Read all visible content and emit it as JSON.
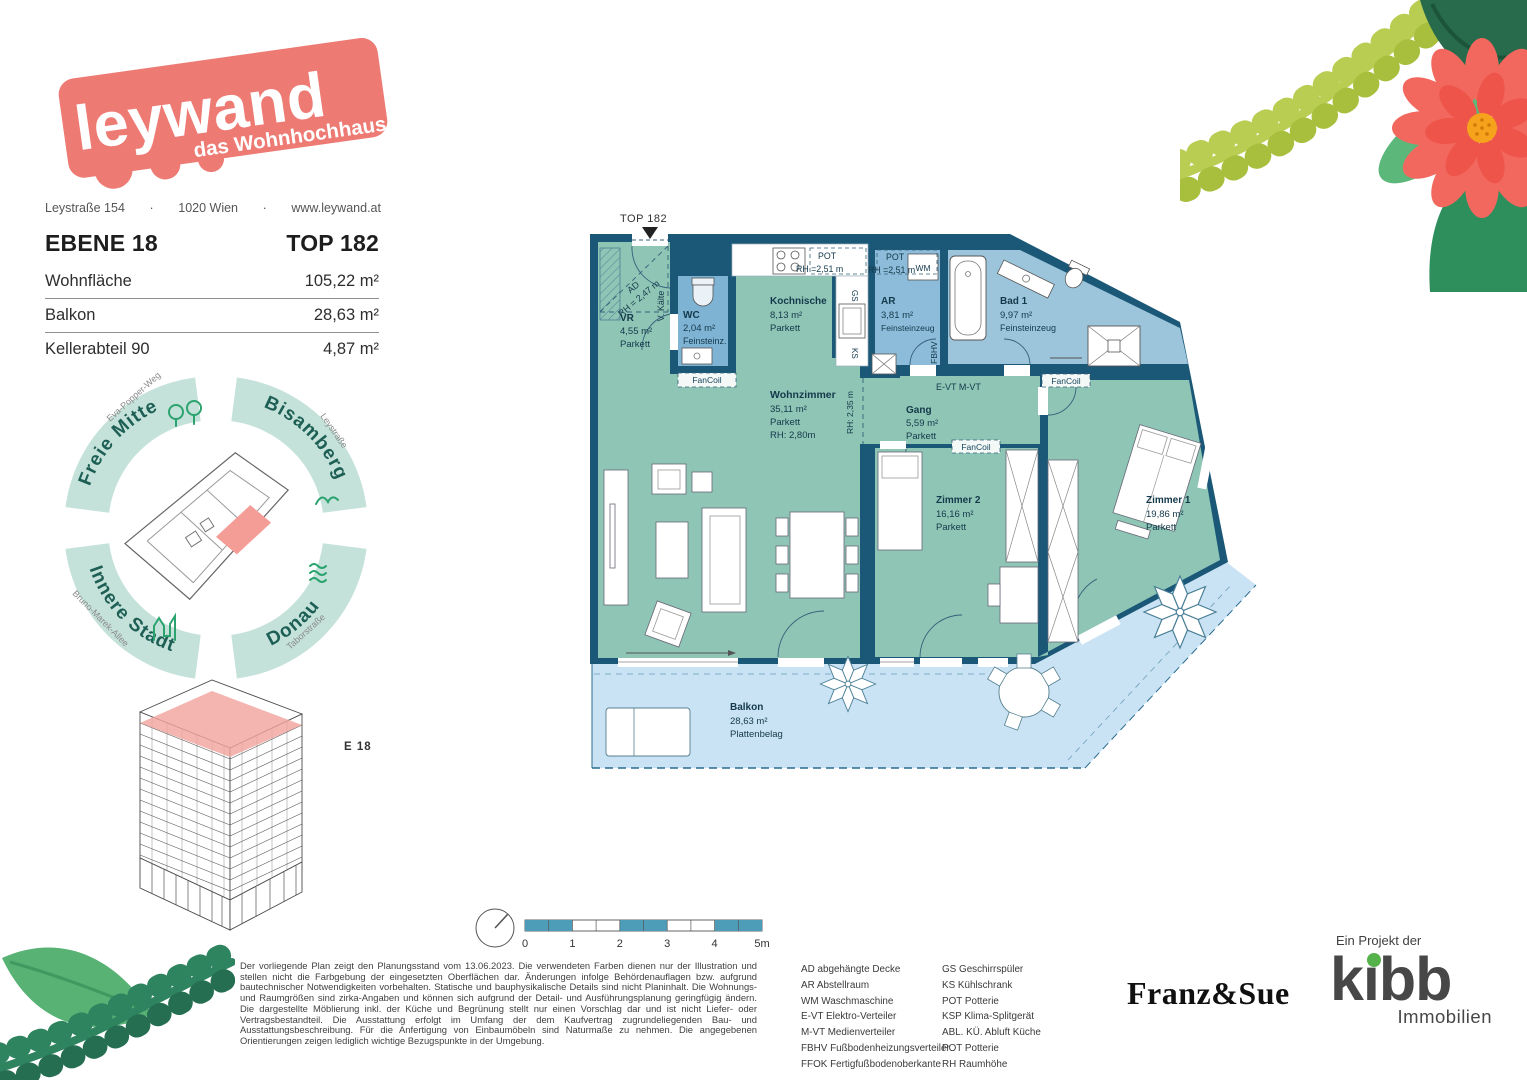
{
  "brand": {
    "logo_line1": "leywand",
    "logo_line2": "das Wohnhochhaus",
    "address_street": "Leystraße 154",
    "address_city": "1020 Wien",
    "address_web": "www.leywand.at",
    "dot": "·"
  },
  "header": {
    "level": "EBENE 18",
    "unit": "TOP 182",
    "rows": [
      {
        "label": "Wohnfläche",
        "value": "105,22 m²"
      },
      {
        "label": "Balkon",
        "value": "28,63 m²"
      },
      {
        "label": "Kellerabteil 90",
        "value": "4,87 m²"
      }
    ]
  },
  "compass": {
    "nw": {
      "label": "Freie Mitte",
      "street": "Eva-Popper-Weg"
    },
    "ne": {
      "label": "Bisamberg",
      "street": "Leystraße"
    },
    "sw": {
      "label": "Innere Stadt",
      "street": "Bruno-Marek-Allee"
    },
    "se": {
      "label": "Donau",
      "street": "Taborstraße"
    }
  },
  "building": {
    "floor_label": "E 18"
  },
  "plan": {
    "entry_marker": "TOP 182",
    "rooms": {
      "vr": {
        "name": "VR",
        "area": "4,55 m²",
        "floor": "Parkett"
      },
      "wc": {
        "name": "WC",
        "area": "2,04 m²",
        "floor": "Feinsteinz."
      },
      "kochnische": {
        "name": "Kochnische",
        "area": "8,13 m²",
        "floor": "Parkett"
      },
      "ar": {
        "name": "AR",
        "area": "3,81 m²",
        "floor": "Feinsteinzeug"
      },
      "bad": {
        "name": "Bad 1",
        "area": "9,97 m²",
        "floor": "Feinsteinzeug"
      },
      "wohnzimmer": {
        "name": "Wohnzimmer",
        "area": "35,11 m²",
        "floor": "Parkett",
        "rh": "RH: 2,80m"
      },
      "gang": {
        "name": "Gang",
        "area": "5,59 m²",
        "floor": "Parkett"
      },
      "zimmer2": {
        "name": "Zimmer 2",
        "area": "16,16 m²",
        "floor": "Parkett"
      },
      "zimmer1": {
        "name": "Zimmer 1",
        "area": "19,86 m²",
        "floor": "Parkett"
      },
      "balkon": {
        "name": "Balkon",
        "area": "28,63 m²",
        "floor": "Plattenbelag"
      }
    },
    "ann": {
      "ad": "AD",
      "ad_rh": "RH = 2,47 m",
      "v_kaelte": "V. Kälte",
      "fancoil": "FanCoil",
      "pot": "POT",
      "pot_rh": "RH =2,51 m",
      "gs": "GS",
      "ks": "KS",
      "wm": "WM",
      "fbhv": "FBHV",
      "evt_mvt": "E-VT M-VT",
      "rh235": "RH: 2,35 m"
    }
  },
  "scalebar": {
    "labels": [
      "0",
      "1",
      "2",
      "3",
      "4",
      "5m"
    ]
  },
  "disclaimer": {
    "text": "Der vorliegende Plan zeigt den Planungsstand vom 13.06.2023. Die verwendeten Farben dienen nur der Illustration und stellen nicht die Farbgebung der eingesetzten Oberflächen dar. Änderungen infolge Behördenauflagen bzw. aufgrund bautechnischer Notwendigkeiten vorbehalten. Statische und bauphysikalische Details sind nicht Planinhalt. Die Wohnungs- und Raumgrößen sind zirka-Angaben und können sich aufgrund der Detail- und Ausführungsplanung geringfügig ändern. Die dargestellte Möblierung inkl. der Küche und Begrünung stellt nur einen Vorschlag dar und ist nicht Liefer- oder Vertragsbestandteil. Die Ausstattung erfolgt im Umfang der dem Kaufvertrag zugrundeliegenden Bau- und Ausstattungsbeschreibung. Für die Anfertigung von Einbaumöbeln sind Naturmaße zu nehmen. Die angegebenen Orientierungen zeigen lediglich wichtige Bezugspunkte in der Umgebung."
  },
  "legend": {
    "col1": [
      "AD abgehängte Decke",
      "AR Abstellraum",
      "WM Waschmaschine",
      "E-VT Elektro-Verteiler",
      "M-VT Medienverteiler",
      "FBHV Fußbodenheizungsverteiler",
      "FFOK Fertigfußbodenoberkante"
    ],
    "col2": [
      "GS Geschirrspüler",
      "KS Kühlschrank",
      "POT Potterie",
      "KSP Klima-Splitgerät",
      "ABL. KÜ.  Abluft Küche",
      "POT Potterie",
      "RH Raumhöhe"
    ]
  },
  "footer": {
    "architect": "Franz&Sue",
    "project_prefix": "Ein Projekt der",
    "developer": "kıbb",
    "developer_sub": "Immobilien"
  },
  "colors": {
    "brand_pink": "#ee7a74",
    "wall_blue": "#1b5878",
    "room_teal": "#8fc5b5",
    "room_blue": "#8cbcd9",
    "balcony_blue": "#c9e3f4",
    "compass_mint": "#c5e2da",
    "compass_text": "#1e5f55",
    "scalebar_teal": "#4e9db8",
    "kibb_green": "#55b24a"
  }
}
